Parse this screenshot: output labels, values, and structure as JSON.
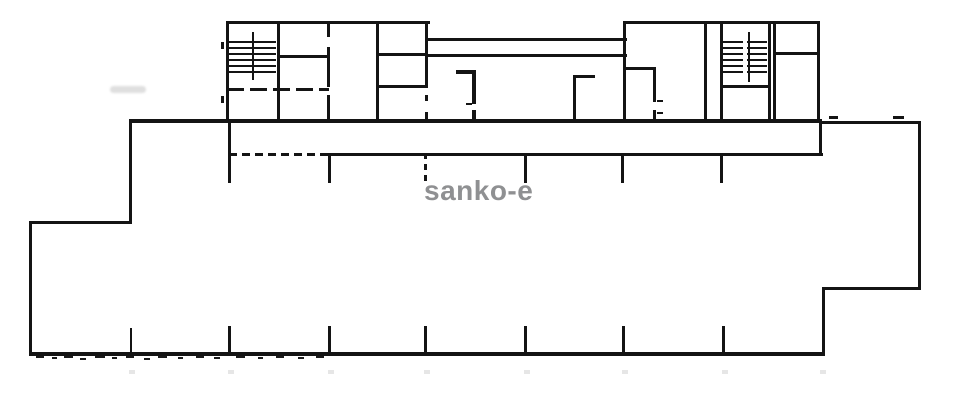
{
  "page": {
    "background": "#ffffff"
  },
  "watermark": {
    "text": "sanko-e",
    "color": "#8f9092"
  },
  "drawing": {
    "type": "architectural-floor-plan",
    "ink_color": "#141414",
    "description": "Scanned building floor plan: upper row of units with two hatched staircases joined by a double-line corridor bridge, over a large open lower area with partition tick marks along top band and bottom edge, stepped outline at lower-left and lower-right corners",
    "staircase_count": 2,
    "upper_band_tick_count": 6,
    "bottom_edge_tick_count": 7
  }
}
